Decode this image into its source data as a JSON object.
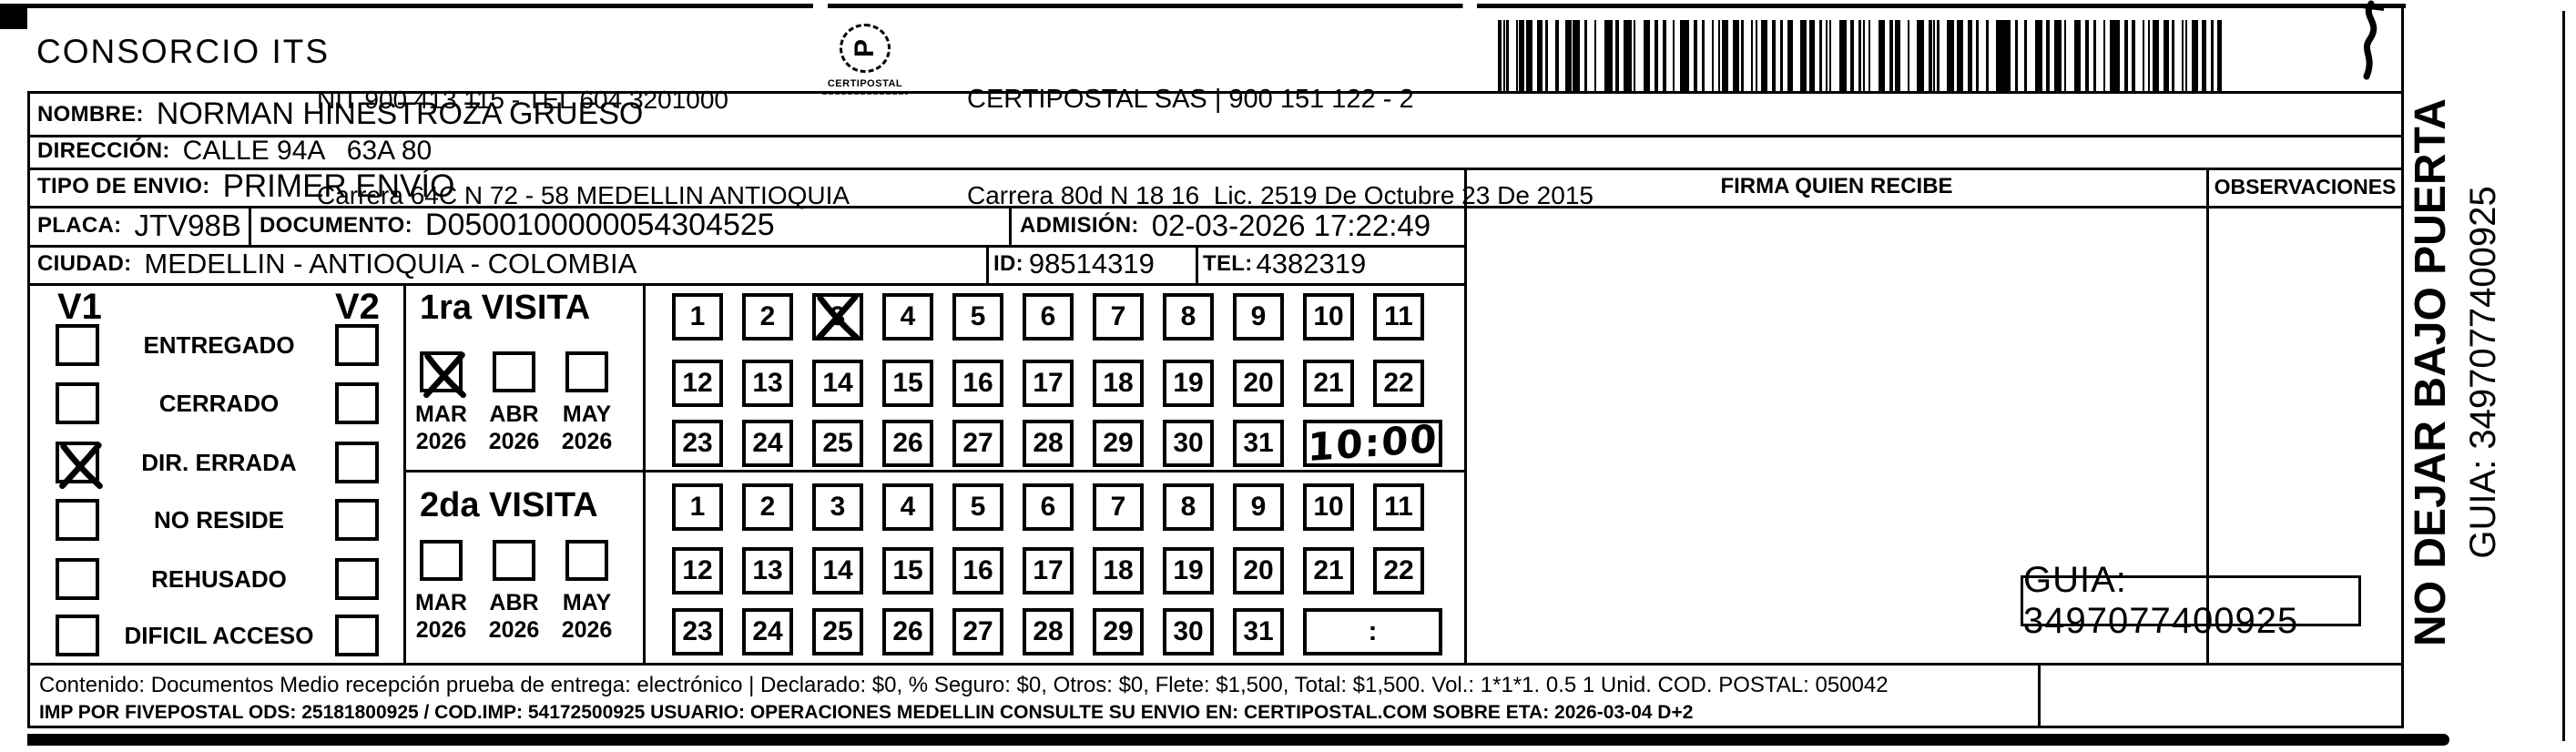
{
  "header": {
    "company": "CONSORCIO ITS",
    "nit_line1": "NIT 900 413 115 - TEL 604 3201000",
    "nit_line2": "Carrera 64C N 72 - 58 MEDELLIN ANTIOQUIA",
    "logo_text": "CERTIPOSTAL",
    "certipostal_line1": "CERTIPOSTAL SAS | 900 151 122 - 2",
    "certipostal_line2": "Carrera 80d N 18 16  Lic. 2519 De Octubre 23 De 2015"
  },
  "recipient": {
    "nombre_label": "NOMBRE:",
    "nombre": "NORMAN HINESTROZA GRUESO",
    "direccion_label": "DIRECCIÓN:",
    "direccion": "CALLE 94A   63A 80",
    "tipo_label": "TIPO DE ENVIO:",
    "tipo": "PRIMER ENVÍO",
    "placa_label": "PLACA:",
    "placa": "JTV98B",
    "documento_label": "DOCUMENTO:",
    "documento": "D0500100000054304525",
    "admision_label": "ADMISIÓN:",
    "admision": "02-03-2026 17:22:49",
    "ciudad_label": "CIUDAD:",
    "ciudad": "MEDELLIN - ANTIOQUIA - COLOMBIA",
    "id_label": "ID:",
    "id": "98514319",
    "tel_label": "TEL:",
    "tel": "4382319"
  },
  "columns": {
    "firma": "FIRMA QUIEN RECIBE",
    "observaciones": "OBSERVACIONES"
  },
  "status": {
    "v1_label": "V1",
    "v2_label": "V2",
    "items": [
      {
        "label": "ENTREGADO",
        "v1": false,
        "v2": false
      },
      {
        "label": "CERRADO",
        "v1": false,
        "v2": false
      },
      {
        "label": "DIR. ERRADA",
        "v1": true,
        "v2": false
      },
      {
        "label": "NO RESIDE",
        "v1": false,
        "v2": false
      },
      {
        "label": "REHUSADO",
        "v1": false,
        "v2": false
      },
      {
        "label": "DIFICIL ACCESO",
        "v1": false,
        "v2": false
      }
    ]
  },
  "visits": {
    "first": {
      "title": "1ra VISITA",
      "months": [
        {
          "label": "MAR",
          "year": "2026",
          "checked": true
        },
        {
          "label": "ABR",
          "year": "2026",
          "checked": false
        },
        {
          "label": "MAY",
          "year": "2026",
          "checked": false
        }
      ],
      "day_rows": [
        [
          1,
          2,
          3,
          4,
          5,
          6,
          7,
          8,
          9,
          10,
          11
        ],
        [
          12,
          13,
          14,
          15,
          16,
          17,
          18,
          19,
          20,
          21,
          22
        ],
        [
          23,
          24,
          25,
          26,
          27,
          28,
          29,
          30,
          31
        ]
      ],
      "crossed_day": 3,
      "hour_value": "10:00",
      "hour_handwritten": true
    },
    "second": {
      "title": "2da VISITA",
      "months": [
        {
          "label": "MAR",
          "year": "2026",
          "checked": false
        },
        {
          "label": "ABR",
          "year": "2026",
          "checked": false
        },
        {
          "label": "MAY",
          "year": "2026",
          "checked": false
        }
      ],
      "day_rows": [
        [
          1,
          2,
          3,
          4,
          5,
          6,
          7,
          8,
          9,
          10,
          11
        ],
        [
          12,
          13,
          14,
          15,
          16,
          17,
          18,
          19,
          20,
          21,
          22
        ],
        [
          23,
          24,
          25,
          26,
          27,
          28,
          29,
          30,
          31
        ]
      ],
      "crossed_day": null,
      "hour_value": ":",
      "hour_handwritten": false
    }
  },
  "sidebar": {
    "warning": "NO DEJAR BAJO PUERTA",
    "guia": "GUIA: 3497077400925"
  },
  "footer": {
    "line1": "Contenido: Documentos Medio recepción prueba de entrega: electrónico | Declarado: $0, % Seguro: $0, Otros: $0, Flete: $1,500, Total: $1,500. Vol.: 1*1*1. 0.5  1 Unid. COD. POSTAL: 050042",
    "line2": "IMP POR FIVEPOSTAL ODS: 25181800925 / COD.IMP: 54172500925 USUARIO: OPERACIONES MEDELLIN CONSULTE SU ENVIO EN: CERTIPOSTAL.COM SOBRE ETA: 2026-03-04 D+2",
    "guia": "GUIA: 3497077400925"
  }
}
